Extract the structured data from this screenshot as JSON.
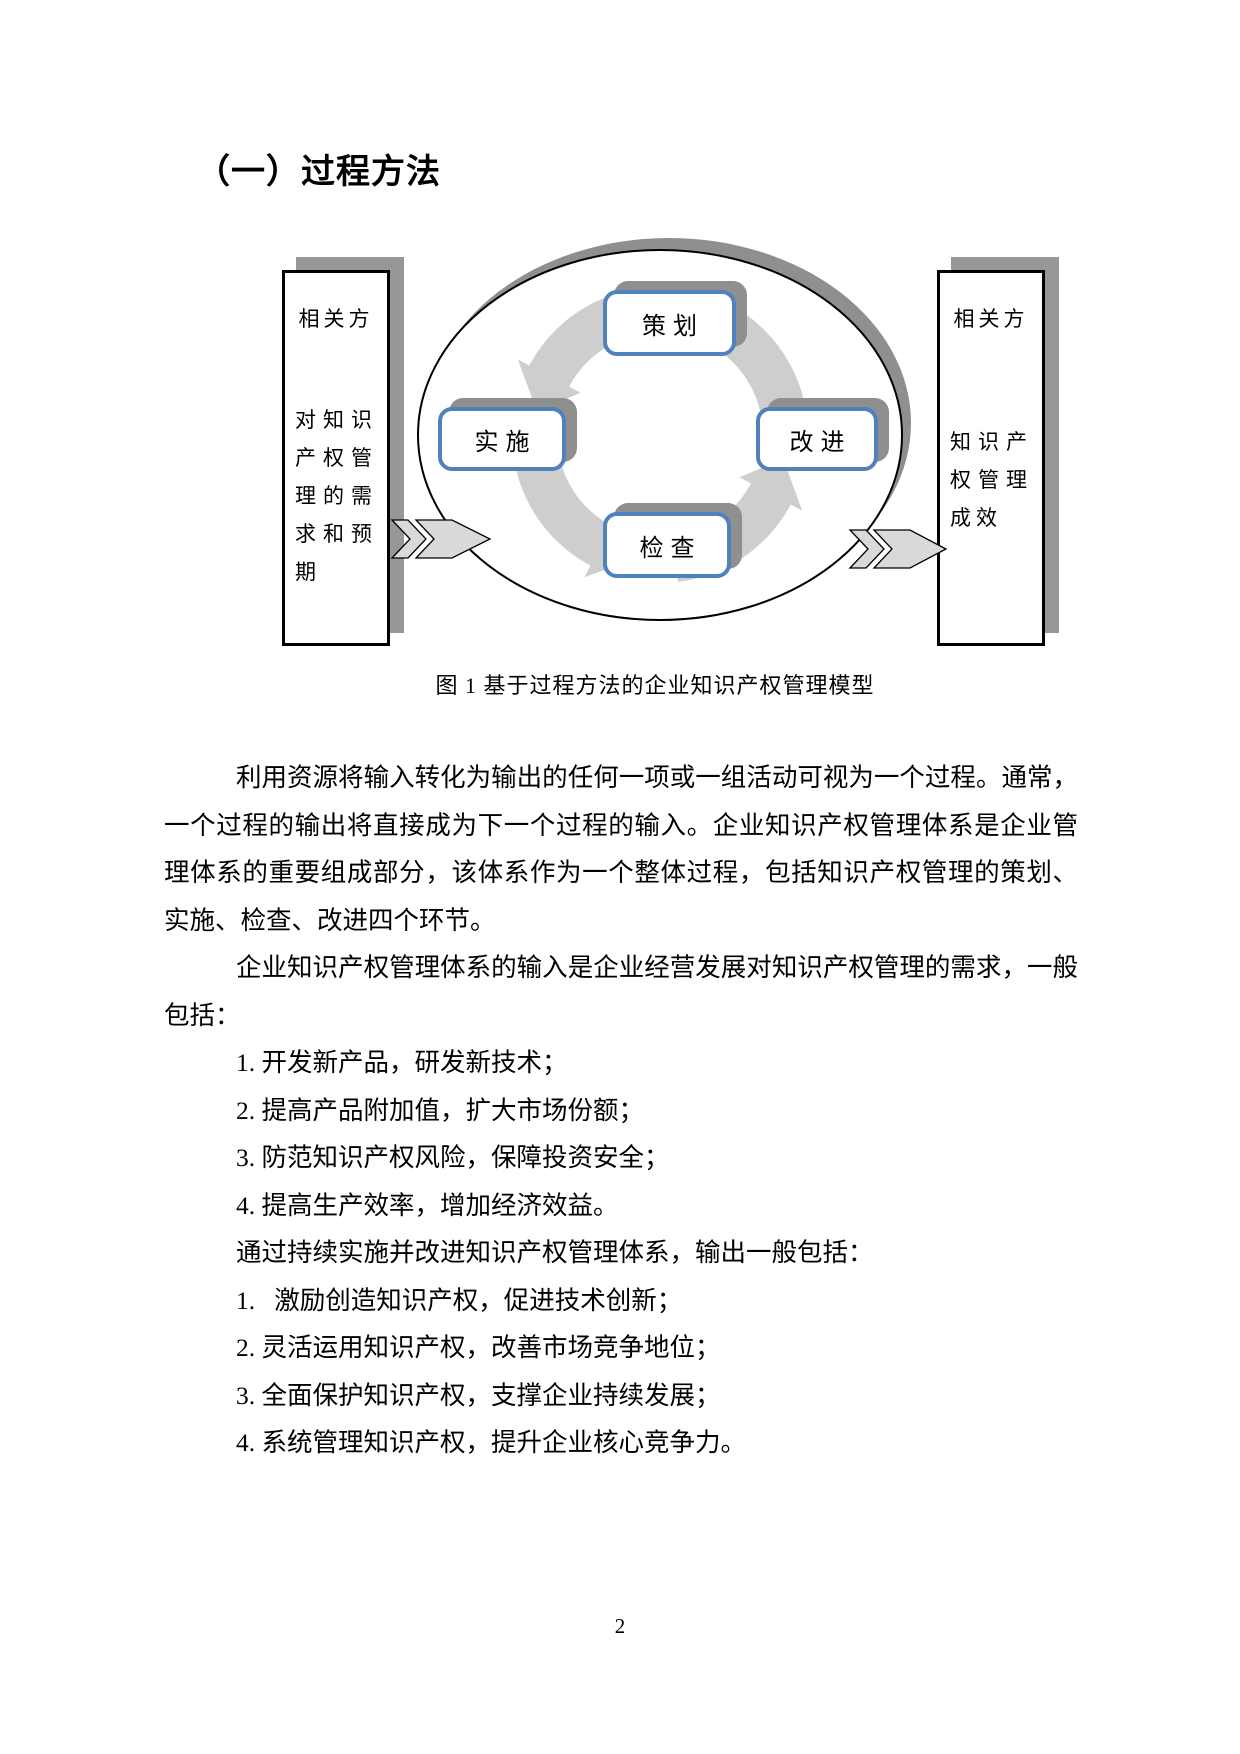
{
  "heading": "（一）过程方法",
  "figure": {
    "caption": "图 1 基于过程方法的企业知识产权管理模型",
    "left_box": {
      "title": "相关方",
      "body": "对知识产权管理的需求和预期"
    },
    "right_box": {
      "title": "相关方",
      "body": "知识产权管理成效"
    },
    "nodes": {
      "plan": "策划",
      "do": "实施",
      "check": "检查",
      "act": "改进"
    }
  },
  "body": {
    "p1": "利用资源将输入转化为输出的任何一项或一组活动可视为一个过程。通常，一个过程的输出将直接成为下一个过程的输入。企业知识产权管理体系是企业管理体系的重要组成部分，该体系作为一个整体过程，包括知识产权管理的策划、实施、检查、改进四个环节。",
    "p2": "企业知识产权管理体系的输入是企业经营发展对知识产权管理的需求，一般包括：",
    "input_items": [
      "1. 开发新产品，研发新技术；",
      "2. 提高产品附加值，扩大市场份额；",
      "3. 防范知识产权风险，保障投资安全；",
      "4. 提高生产效率，增加经济效益。"
    ],
    "p3": "通过持续实施并改进知识产权管理体系，输出一般包括：",
    "output_items": [
      "1.   激励创造知识产权，促进技术创新；",
      "2. 灵活运用知识产权，改善市场竞争地位；",
      "3. 全面保护知识产权，支撑企业持续发展；",
      "4. 系统管理知识产权，提升企业核心竞争力。"
    ]
  },
  "page_number": "2",
  "colors": {
    "node_border_blue": "#4f81bd",
    "shadow_gray": "#8f8f8f",
    "arrow_gray": "#cecece",
    "block_arrow_gray": "#d9d9d9"
  }
}
